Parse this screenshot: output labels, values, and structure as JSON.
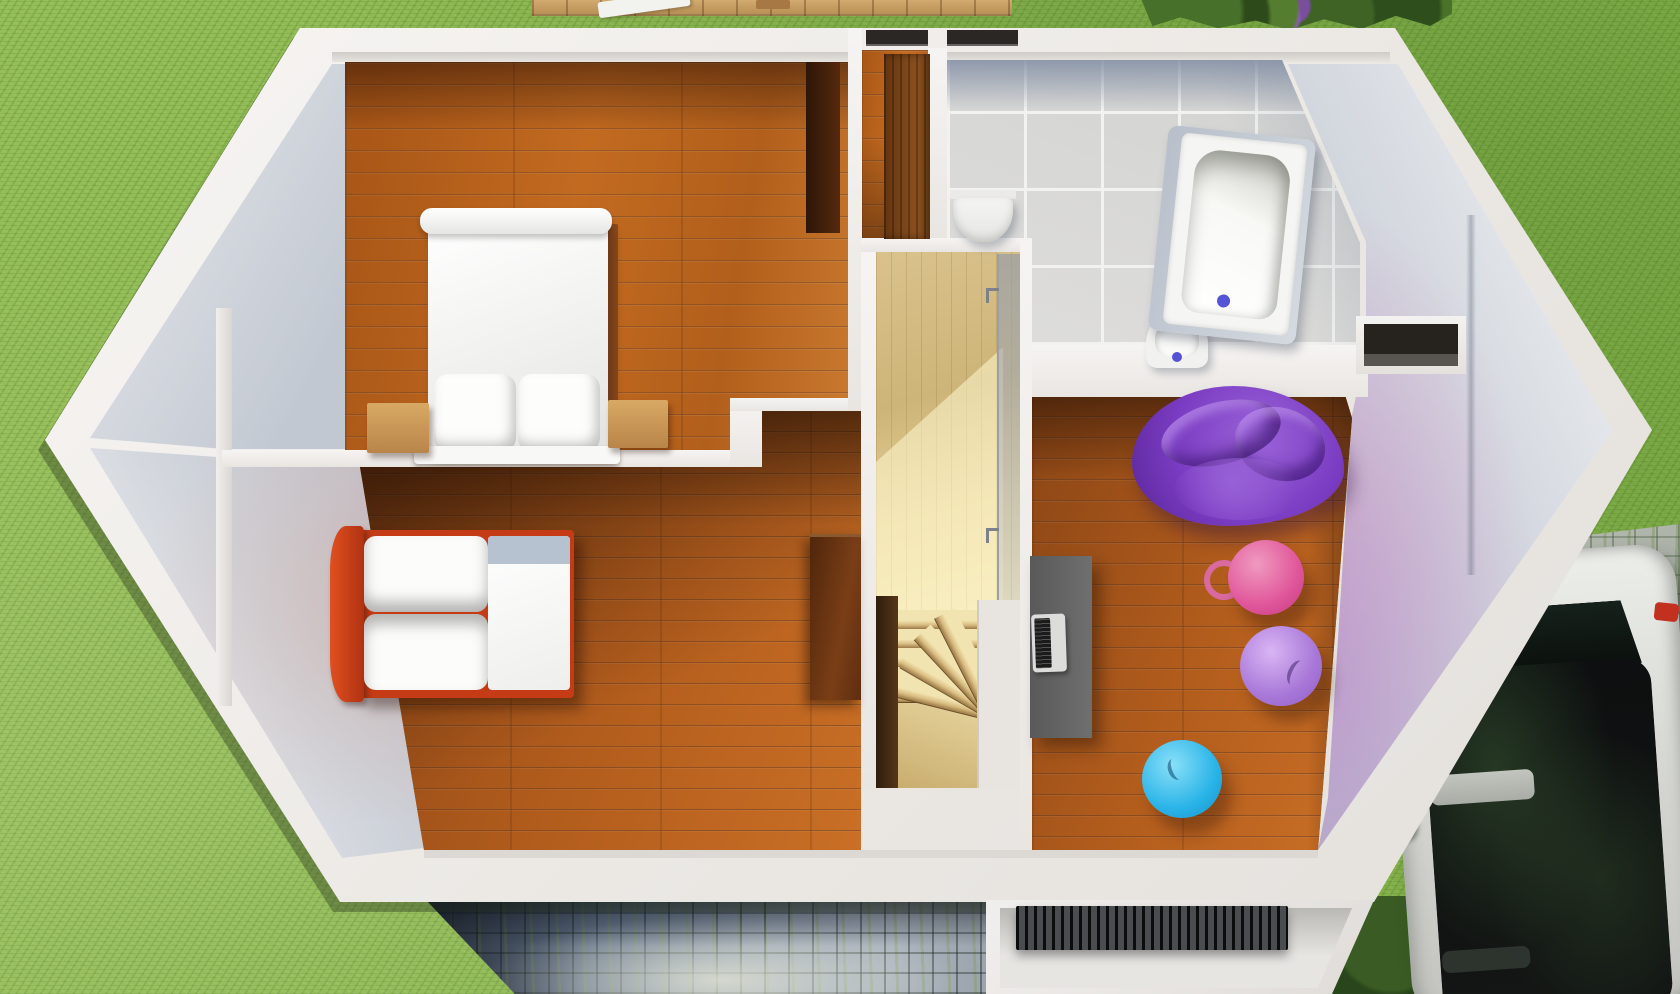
{
  "scene": {
    "description": "Top-down 3D render of an upper-storey floor plan",
    "view": "top-down axonometric",
    "rooms": [
      "double-bedroom",
      "single-bedroom",
      "bathroom",
      "stair-landing",
      "hobby-room",
      "closet-nook"
    ],
    "outdoor": [
      "lawn",
      "wooden-deck",
      "hedge-with-purple-flowers",
      "cobblestone-patio",
      "entrance-porch",
      "cobblestone-driveway",
      "parked-car"
    ],
    "furniture": [
      "double-bed",
      "two-nightstands",
      "tall-dark-wardrobe",
      "single-bed-red-frame",
      "second-wardrobe",
      "closet-cabinet",
      "bathtub",
      "toilet",
      "wash-basin",
      "desk",
      "laptop",
      "purple-beanbag-sofa",
      "pink-gym-ball",
      "lavender-gym-ball",
      "blue-gym-ball",
      "winder-staircase",
      "glass-railing",
      "floor-grate"
    ]
  },
  "palette": {
    "grass": "#8ab44c",
    "wall_white": "#f3f1ef",
    "roof_slope_gray": "#c9ced6",
    "wood_floor": "#b5621c",
    "wood_dark": "#5a2c10",
    "stair_wood": "#e3cf9e",
    "tile_gray": "#d7d8d6",
    "tile_shadow_band": "#8f9ab0",
    "bed_frame_red": "#c43b16",
    "beanbag_purple": "#7a3cc2",
    "ball_pink": "#e0569a",
    "ball_lavender": "#a878d8",
    "ball_blue": "#2ab4e8",
    "drain_blue": "#5553d6",
    "desk_gray": "#666666",
    "cobble_patio": "#8494a8",
    "cobble_driveway": "#a9afa6",
    "car_body": "#e2e3df",
    "car_glass": "#0b0d0e",
    "porch_grate": "#3f4246"
  }
}
